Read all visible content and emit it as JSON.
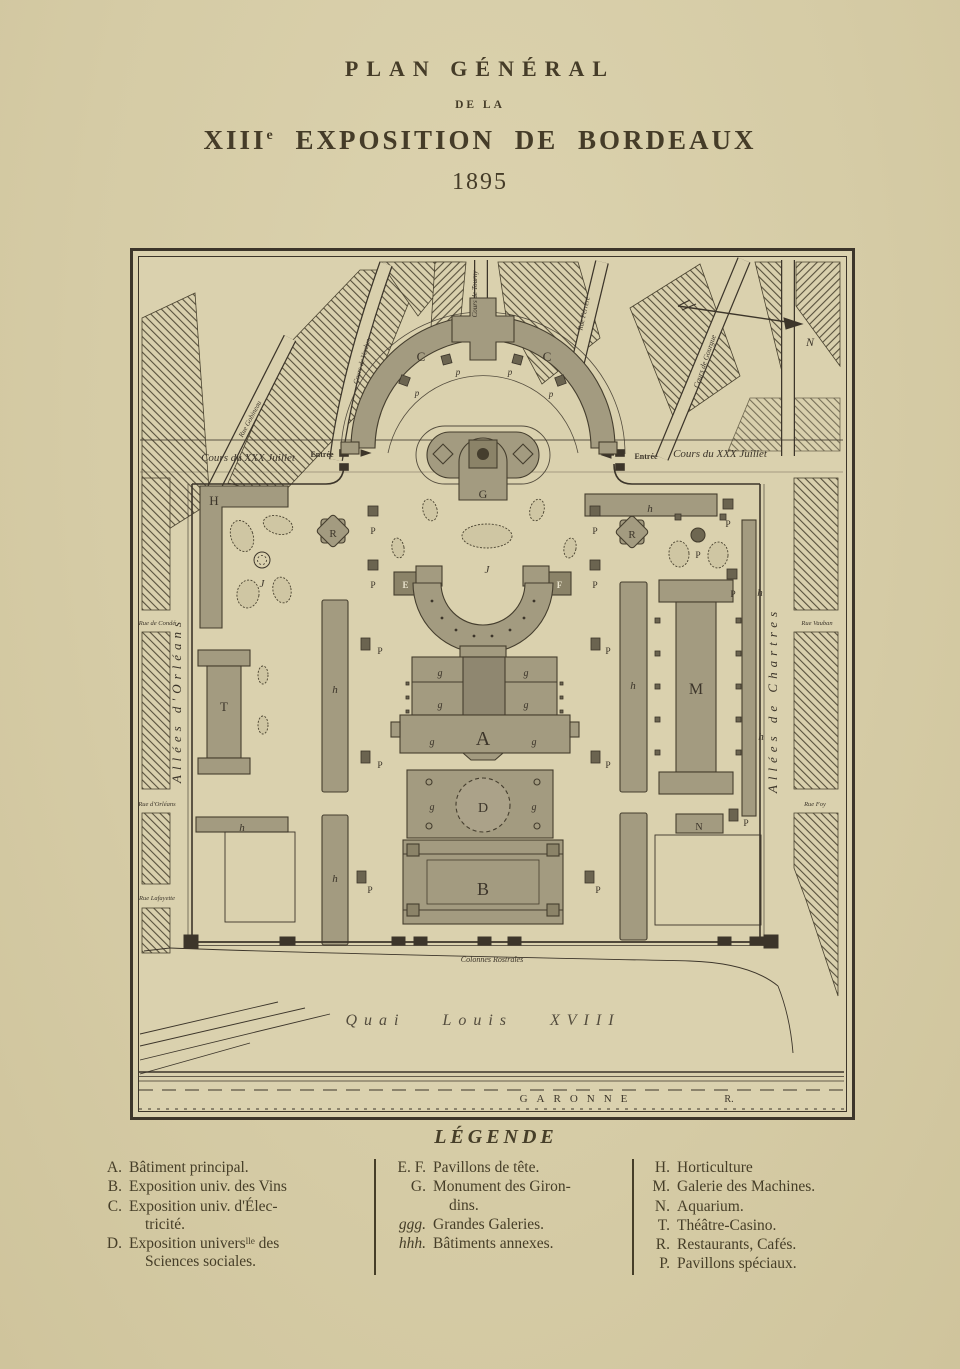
{
  "title": {
    "line1": "PLAN GÉNÉRAL",
    "line2": "DE LA",
    "line3_roman": "XIII",
    "line3_sup": "e",
    "line3_rest": " EXPOSITION DE BORDEAUX",
    "year": "1895"
  },
  "map": {
    "labels": [
      {
        "t": "Cours du XXX Juillet",
        "x": 118,
        "y": 213,
        "s": 11,
        "cls": "it",
        "name": "street-cours-du-xxx-juillet-left"
      },
      {
        "t": "Cours du XXX Juillet",
        "x": 590,
        "y": 209,
        "s": 11,
        "cls": "it",
        "name": "street-cours-du-xxx-juillet-right"
      },
      {
        "t": "Entrée",
        "x": 192,
        "y": 209,
        "s": 8,
        "cls": "b",
        "name": "entrance-left"
      },
      {
        "t": "Entrée",
        "x": 516,
        "y": 211,
        "s": 8,
        "cls": "b",
        "name": "entrance-right"
      },
      {
        "t": "Rue Gobineau",
        "x": 122,
        "y": 172,
        "s": 7,
        "r": -62,
        "cls": "it",
        "name": "street-rue-gobineau"
      },
      {
        "t": "Cours de Verdun",
        "x": 234,
        "y": 114,
        "s": 7,
        "r": -74,
        "cls": "it",
        "name": "street-cours-de-verdun"
      },
      {
        "t": "Cours de Tourny",
        "x": 347,
        "y": 46,
        "s": 7,
        "r": -90,
        "cls": "it",
        "name": "street-cours-de-tourny"
      },
      {
        "t": "Rue Ferrère",
        "x": 456,
        "y": 66,
        "s": 7,
        "r": -77,
        "cls": "it",
        "name": "street-rue-ferrere"
      },
      {
        "t": "Cours de Gourgue",
        "x": 577,
        "y": 114,
        "s": 7.5,
        "r": -71,
        "cls": "it",
        "name": "street-cours-de-gourgue"
      },
      {
        "t": "Allées d'Orléans",
        "x": 51,
        "y": 452,
        "s": 13,
        "r": -90,
        "ls": 5,
        "cls": "it",
        "name": "street-allees-d-orleans"
      },
      {
        "t": "Allées de Chartres",
        "x": 647,
        "y": 452,
        "s": 13,
        "r": -90,
        "ls": 5,
        "cls": "it",
        "name": "street-allees-de-chartres"
      },
      {
        "t": "Rue de Condé",
        "x": 27,
        "y": 377,
        "s": 6.5,
        "cls": "it",
        "name": "street-rue-de-conde"
      },
      {
        "t": "Rue d'Orléans",
        "x": 27,
        "y": 558,
        "s": 6.5,
        "cls": "it",
        "name": "street-rue-d-orleans"
      },
      {
        "t": "Rue Lafayette",
        "x": 27,
        "y": 652,
        "s": 6.5,
        "cls": "it",
        "name": "street-rue-lafayette"
      },
      {
        "t": "Rue Vauban",
        "x": 687,
        "y": 377,
        "s": 6.5,
        "cls": "it",
        "name": "street-rue-vauban"
      },
      {
        "t": "Rue Foy",
        "x": 685,
        "y": 558,
        "s": 6.5,
        "cls": "it",
        "name": "street-rue-foy"
      },
      {
        "t": "Colonnes Rostrales",
        "x": 362,
        "y": 714,
        "s": 8,
        "cls": "it",
        "name": "label-colonnes-rostrales"
      },
      {
        "t": "Quai Louis XVIII",
        "x": 353,
        "y": 777,
        "s": 16,
        "cls": "it sc",
        "name": "label-quai-louis-xviii"
      },
      {
        "t": "GARONNE",
        "x": 448,
        "y": 854,
        "s": 11,
        "ls": 9,
        "name": "label-garonne"
      },
      {
        "t": "R.",
        "x": 599,
        "y": 854,
        "s": 10,
        "name": "label-garonne-r"
      },
      {
        "t": "N",
        "x": 680,
        "y": 98,
        "s": 12,
        "cls": "it",
        "name": "compass-n-label"
      },
      {
        "t": "C",
        "x": 291,
        "y": 113,
        "s": 13,
        "name": "building-c-label-left"
      },
      {
        "t": "C",
        "x": 417,
        "y": 113,
        "s": 13,
        "name": "building-c-label-right"
      },
      {
        "t": "G",
        "x": 353,
        "y": 250,
        "s": 12,
        "name": "building-g-label"
      },
      {
        "t": "H",
        "x": 84,
        "y": 257,
        "s": 13,
        "name": "building-h-label"
      },
      {
        "t": "J",
        "x": 132,
        "y": 339,
        "s": 11,
        "cls": "it",
        "name": "garden-j-label-left"
      },
      {
        "t": "J",
        "x": 357,
        "y": 325,
        "s": 11,
        "cls": "it",
        "name": "garden-j-label-center"
      },
      {
        "t": "R",
        "x": 203,
        "y": 289,
        "s": 11,
        "name": "building-r-label-left"
      },
      {
        "t": "R",
        "x": 502,
        "y": 290,
        "s": 11,
        "name": "building-r-label-right"
      },
      {
        "t": "E",
        "x": 275.5,
        "y": 340,
        "s": 9,
        "cls": "w b",
        "name": "building-e-label"
      },
      {
        "t": "F",
        "x": 429.5,
        "y": 340,
        "s": 9,
        "cls": "w b",
        "name": "building-f-label"
      },
      {
        "t": "T",
        "x": 94,
        "y": 463,
        "s": 13,
        "name": "building-t-label"
      },
      {
        "t": "M",
        "x": 566,
        "y": 446,
        "s": 16,
        "name": "building-m-label"
      },
      {
        "t": "N",
        "x": 569,
        "y": 582,
        "s": 10,
        "name": "building-n-label"
      },
      {
        "t": "A",
        "x": 353,
        "y": 497,
        "s": 20,
        "name": "building-a-label"
      },
      {
        "t": "D",
        "x": 353,
        "y": 564,
        "s": 14,
        "name": "building-d-label"
      },
      {
        "t": "B",
        "x": 353,
        "y": 647,
        "s": 18,
        "name": "building-b-label"
      },
      {
        "t": "g",
        "x": 310,
        "y": 428,
        "s": 10,
        "cls": "it",
        "name": "gallery-g-label"
      },
      {
        "t": "g",
        "x": 396,
        "y": 428,
        "s": 10,
        "cls": "it",
        "name": "gallery-g-label"
      },
      {
        "t": "g",
        "x": 310,
        "y": 460,
        "s": 10,
        "cls": "it",
        "name": "gallery-g-label"
      },
      {
        "t": "g",
        "x": 396,
        "y": 460,
        "s": 10,
        "cls": "it",
        "name": "gallery-g-label"
      },
      {
        "t": "g",
        "x": 302,
        "y": 497,
        "s": 10,
        "cls": "it",
        "name": "gallery-g-label"
      },
      {
        "t": "g",
        "x": 404,
        "y": 497,
        "s": 10,
        "cls": "it",
        "name": "gallery-g-label"
      },
      {
        "t": "g",
        "x": 302,
        "y": 562,
        "s": 10,
        "cls": "it",
        "name": "gallery-g-label"
      },
      {
        "t": "g",
        "x": 404,
        "y": 562,
        "s": 10,
        "cls": "it",
        "name": "gallery-g-label"
      },
      {
        "t": "h",
        "x": 205,
        "y": 445,
        "s": 11,
        "cls": "it",
        "name": "annex-h-label"
      },
      {
        "t": "h",
        "x": 205,
        "y": 634,
        "s": 11,
        "cls": "it",
        "name": "annex-h-label"
      },
      {
        "t": "h",
        "x": 112,
        "y": 583,
        "s": 11,
        "cls": "it",
        "name": "annex-h-label"
      },
      {
        "t": "h",
        "x": 520,
        "y": 264,
        "s": 11,
        "cls": "it",
        "name": "annex-h-label"
      },
      {
        "t": "h",
        "x": 503,
        "y": 441,
        "s": 11,
        "cls": "it",
        "name": "annex-h-label"
      },
      {
        "t": "h",
        "x": 630,
        "y": 348,
        "s": 11,
        "cls": "it",
        "name": "annex-h-label"
      },
      {
        "t": "h",
        "x": 631,
        "y": 492,
        "s": 11,
        "cls": "it",
        "name": "annex-h-label"
      },
      {
        "t": "p",
        "x": 287,
        "y": 148,
        "s": 9,
        "cls": "it",
        "name": "pavilion-p-label"
      },
      {
        "t": "p",
        "x": 328,
        "y": 127,
        "s": 9,
        "cls": "it",
        "name": "pavilion-p-label"
      },
      {
        "t": "p",
        "x": 380,
        "y": 127,
        "s": 9,
        "cls": "it",
        "name": "pavilion-p-label"
      },
      {
        "t": "p",
        "x": 421,
        "y": 149,
        "s": 9,
        "cls": "it",
        "name": "pavilion-p-label"
      },
      {
        "t": "P",
        "x": 243,
        "y": 286,
        "s": 9.5,
        "name": "pavilion-p-label"
      },
      {
        "t": "P",
        "x": 243,
        "y": 340,
        "s": 9.5,
        "name": "pavilion-p-label"
      },
      {
        "t": "P",
        "x": 465,
        "y": 286,
        "s": 9.5,
        "name": "pavilion-p-label"
      },
      {
        "t": "P",
        "x": 465,
        "y": 340,
        "s": 9.5,
        "name": "pavilion-p-label"
      },
      {
        "t": "P",
        "x": 250,
        "y": 406,
        "s": 9.5,
        "name": "pavilion-p-label"
      },
      {
        "t": "P",
        "x": 478,
        "y": 406,
        "s": 9.5,
        "name": "pavilion-p-label"
      },
      {
        "t": "P",
        "x": 250,
        "y": 520,
        "s": 9.5,
        "name": "pavilion-p-label"
      },
      {
        "t": "P",
        "x": 478,
        "y": 520,
        "s": 9.5,
        "name": "pavilion-p-label"
      },
      {
        "t": "P",
        "x": 240,
        "y": 645,
        "s": 9.5,
        "name": "pavilion-p-label"
      },
      {
        "t": "P",
        "x": 468,
        "y": 645,
        "s": 9.5,
        "name": "pavilion-p-label"
      },
      {
        "t": "P",
        "x": 598,
        "y": 279,
        "s": 9.5,
        "name": "pavilion-p-label"
      },
      {
        "t": "P",
        "x": 603,
        "y": 349,
        "s": 9.5,
        "name": "pavilion-p-label"
      },
      {
        "t": "P",
        "x": 616,
        "y": 578,
        "s": 9.5,
        "name": "pavilion-p-label"
      },
      {
        "t": "P",
        "x": 568,
        "y": 310,
        "s": 9.5,
        "name": "pavilion-p-label"
      }
    ],
    "squares": [
      {
        "x": 270,
        "y": 128,
        "w": 9,
        "h": 9,
        "r": 20
      },
      {
        "x": 312,
        "y": 107,
        "w": 9,
        "h": 9,
        "r": -15
      },
      {
        "x": 383,
        "y": 107,
        "w": 9,
        "h": 9,
        "r": 15
      },
      {
        "x": 426,
        "y": 128,
        "w": 9,
        "h": 9,
        "r": -20
      },
      {
        "x": 238,
        "y": 258,
        "w": 10,
        "h": 10
      },
      {
        "x": 238,
        "y": 312,
        "w": 10,
        "h": 10
      },
      {
        "x": 460,
        "y": 258,
        "w": 10,
        "h": 10
      },
      {
        "x": 460,
        "y": 312,
        "w": 10,
        "h": 10
      },
      {
        "x": 231,
        "y": 390,
        "w": 9,
        "h": 12
      },
      {
        "x": 461,
        "y": 390,
        "w": 9,
        "h": 12
      },
      {
        "x": 231,
        "y": 503,
        "w": 9,
        "h": 12
      },
      {
        "x": 461,
        "y": 503,
        "w": 9,
        "h": 12
      },
      {
        "x": 227,
        "y": 623,
        "w": 9,
        "h": 12
      },
      {
        "x": 455,
        "y": 623,
        "w": 9,
        "h": 12
      },
      {
        "x": 593,
        "y": 251,
        "w": 10,
        "h": 10
      },
      {
        "x": 597,
        "y": 321,
        "w": 10,
        "h": 10
      },
      {
        "x": 599,
        "y": 561,
        "w": 9,
        "h": 12
      },
      {
        "x": 525,
        "y": 370,
        "w": 5,
        "h": 5
      },
      {
        "x": 525,
        "y": 403,
        "w": 5,
        "h": 5
      },
      {
        "x": 525,
        "y": 436,
        "w": 5,
        "h": 5
      },
      {
        "x": 525,
        "y": 469,
        "w": 5,
        "h": 5
      },
      {
        "x": 525,
        "y": 502,
        "w": 5,
        "h": 5
      },
      {
        "x": 606,
        "y": 370,
        "w": 5,
        "h": 5
      },
      {
        "x": 606,
        "y": 403,
        "w": 5,
        "h": 5
      },
      {
        "x": 606,
        "y": 436,
        "w": 5,
        "h": 5
      },
      {
        "x": 606,
        "y": 469,
        "w": 5,
        "h": 5
      },
      {
        "x": 606,
        "y": 502,
        "w": 5,
        "h": 5
      },
      {
        "x": 545,
        "y": 266,
        "w": 6,
        "h": 6
      },
      {
        "x": 590,
        "y": 266,
        "w": 6,
        "h": 6
      },
      {
        "x": 276,
        "y": 434,
        "w": 3,
        "h": 3
      },
      {
        "x": 276,
        "y": 448,
        "w": 3,
        "h": 3
      },
      {
        "x": 276,
        "y": 462,
        "w": 3,
        "h": 3
      },
      {
        "x": 430,
        "y": 434,
        "w": 3,
        "h": 3
      },
      {
        "x": 430,
        "y": 448,
        "w": 3,
        "h": 3
      },
      {
        "x": 430,
        "y": 462,
        "w": 3,
        "h": 3
      }
    ]
  },
  "legend": {
    "title": "LÉGENDE",
    "columns": [
      {
        "items": [
          {
            "key": "A.",
            "lines": [
              "Bâtiment principal."
            ]
          },
          {
            "key": "B.",
            "lines": [
              "Exposition univ. des Vins"
            ]
          },
          {
            "key": "C.",
            "lines": [
              "Exposition univ. d'Élec-",
              "tricité."
            ]
          },
          {
            "key": "D.",
            "lines": [
              "Exposition universˡˡᵉ des",
              "Sciences sociales."
            ]
          }
        ]
      },
      {
        "items": [
          {
            "key": "E. F.",
            "lines": [
              "Pavillons de tête."
            ]
          },
          {
            "key": "G.",
            "lines": [
              "Monument des Giron-",
              "dins."
            ]
          },
          {
            "key": "ggg.",
            "italic": true,
            "lines": [
              "Grandes Galeries."
            ]
          },
          {
            "key": "hhh.",
            "italic": true,
            "lines": [
              "Bâtiments annexes."
            ]
          }
        ]
      },
      {
        "items": [
          {
            "key": "H.",
            "lines": [
              "Horticulture"
            ]
          },
          {
            "key": "M.",
            "lines": [
              "Galerie des Machines."
            ]
          },
          {
            "key": "N.",
            "lines": [
              "Aquarium."
            ]
          },
          {
            "key": "T.",
            "lines": [
              "Théâtre-Casino."
            ]
          },
          {
            "key": "R.",
            "lines": [
              "Restaurants, Cafés."
            ]
          },
          {
            "key": "P.",
            "lines": [
              "Pavillons spéciaux."
            ]
          }
        ]
      }
    ]
  }
}
